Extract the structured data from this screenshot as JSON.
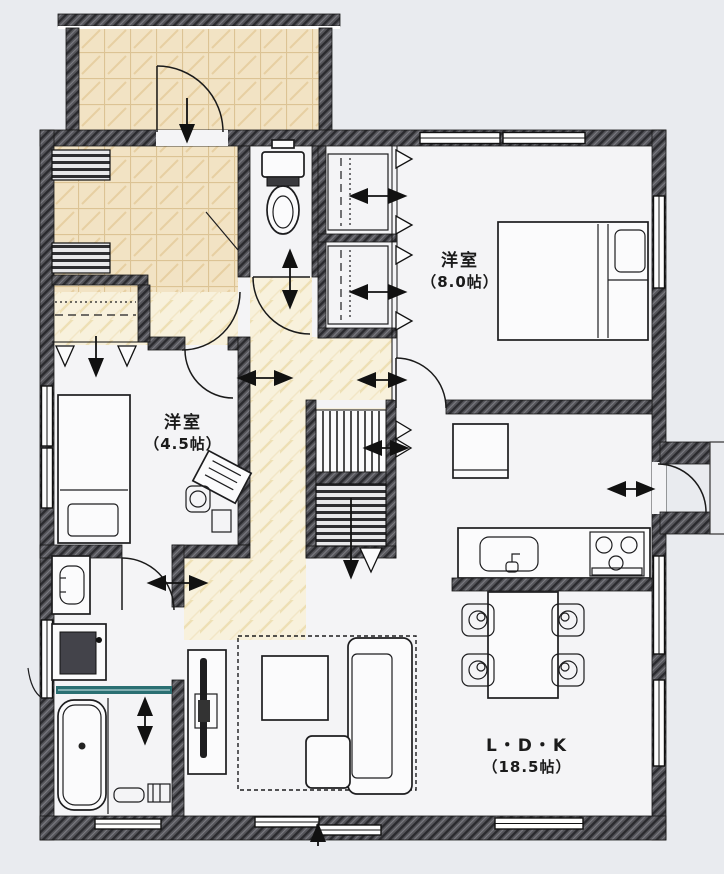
{
  "floor_plan": {
    "title": "1F floor plan",
    "rooms": [
      {
        "id": "western-room-8",
        "name": "洋室",
        "size": "（8.0帖）"
      },
      {
        "id": "western-room-45",
        "name": "洋室",
        "size": "（4.5帖）"
      },
      {
        "id": "ldk",
        "name": "L・D・K",
        "size": "（18.5帖）"
      }
    ],
    "fixtures": [
      "entrance-porch",
      "front-door",
      "shoe-cabinet",
      "entry-closet",
      "toilet",
      "wall-closet-upper",
      "wall-closet-lower",
      "double-bed",
      "single-bed",
      "desk",
      "desk-chair",
      "staircase",
      "refrigerator",
      "kitchen-counter",
      "kitchen-sink",
      "gas-stove",
      "dining-table",
      "dining-chairs",
      "tv-board",
      "tv",
      "rug",
      "coffee-table",
      "sofa",
      "vanity-sink",
      "washing-machine",
      "bath-sliding-door",
      "bathtub",
      "shower-set",
      "rear-exterior-door",
      "windows"
    ],
    "colors": {
      "background": "#e9ebef",
      "floor": "#f4f4f6",
      "wall": "#4b4b4f",
      "entry_tile": "#f2e3c4",
      "hall_wood": "#f8f1dc",
      "bath_door_teal": "#2a6f72",
      "ink": "#1b1b1b"
    }
  }
}
